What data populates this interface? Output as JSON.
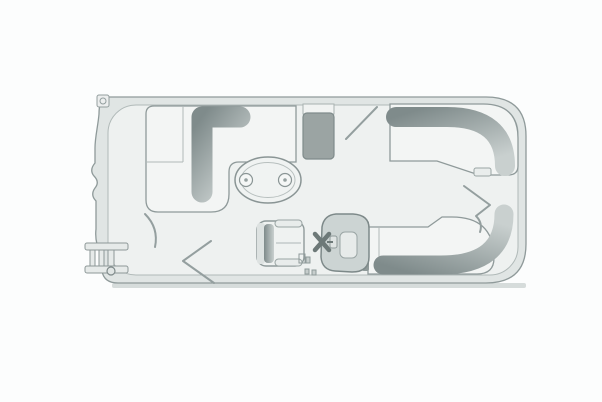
{
  "meta": {
    "description": "Top-down floor plan line drawing of a pontoon boat deck layout",
    "visible_text": ""
  },
  "colors": {
    "background": "#fcfdfd",
    "rail_band": "#e0e5e4",
    "deck": "#eef1f0",
    "upholstery": "#f3f5f4",
    "table_fill": "#f0f3f2",
    "dark_block": "#9ba4a3",
    "console_fill": "#ccd4d3",
    "console_inner": "#e7ebea",
    "band_dark": "#7f8b8b",
    "band_light": "#c9d0cf",
    "outline": "#8f9a9a",
    "shadow": "#c9d0cf"
  },
  "parts": {
    "hull": "pontoon-hull-outline",
    "bow_lounge": "l-shaped-bow-lounge",
    "bow_table": "oval-table-with-cup-holders",
    "storage_block": "bow-storage-console",
    "helm_console": "helm-console",
    "steering_wheel": "steering-wheel",
    "captain_chair": "captains-chair",
    "stern_lounge_top": "stern-lounge-starboard",
    "stern_lounge_bottom": "stern-lounge-port",
    "boarding_ladder": "boarding-ladder",
    "gate_marks": "gate-swing-marks"
  }
}
